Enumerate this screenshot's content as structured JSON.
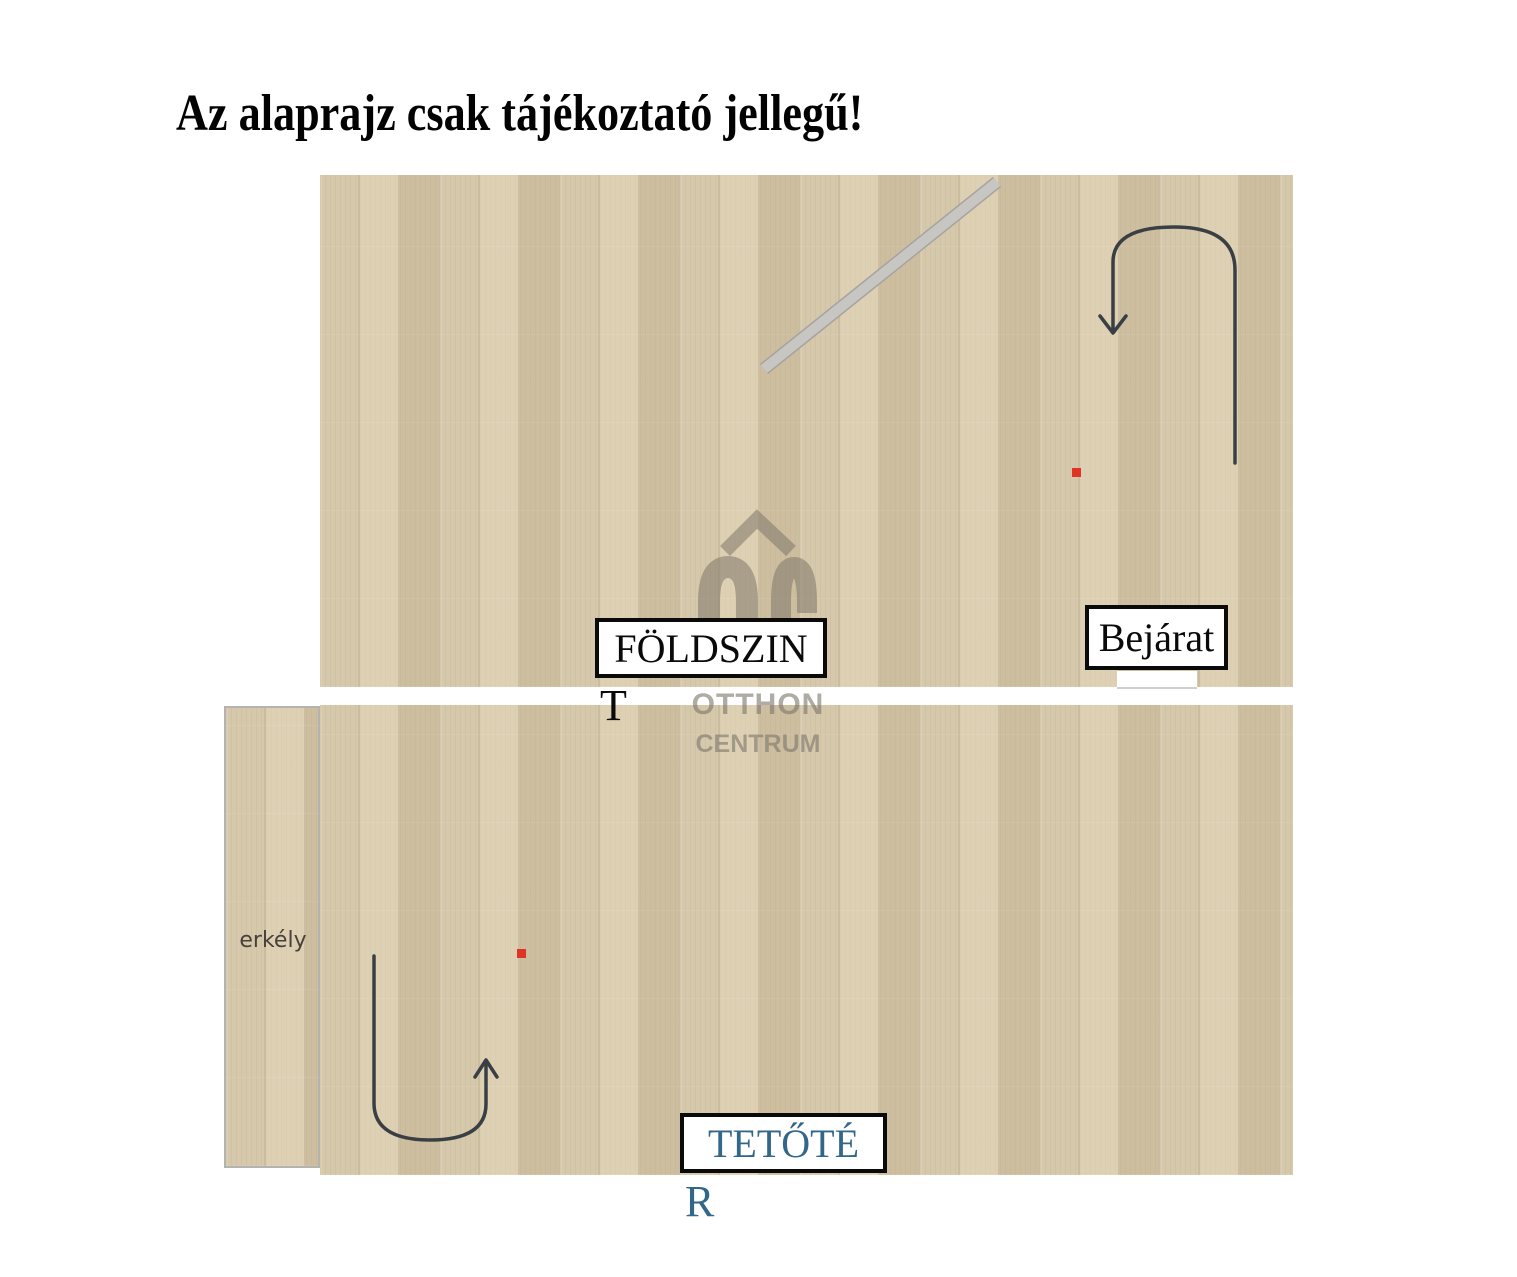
{
  "disclaimer": "Az alaprajz csak tájékoztató jellegű!",
  "watermark": {
    "line1": "OTTHON",
    "line2": "CENTRUM"
  },
  "ground_floor": {
    "name_line1": "FÖLDSZIN",
    "name_line2": "T",
    "bathroom_label": "fürdőszoba",
    "kitchen_label": "Konyha-étkező",
    "entrance_label": "Bejárat"
  },
  "attic_floor": {
    "name_line1": "TETŐTÉ",
    "name_line2": "R",
    "balcony_label": "erkély",
    "room1_label": "szoba",
    "room2_label": "szoba"
  },
  "colors": {
    "wall": "#c8c6c3",
    "wall_edge": "#a6a4a1",
    "wood_base": "#d6c8ab",
    "stair_white": "#fafafa",
    "arrow": "#3a3f45",
    "marker_red": "#df3425",
    "attic_label_blue": "#33678a",
    "room_label_gray": "#48423a",
    "watermark_gray": "#7d766b"
  }
}
